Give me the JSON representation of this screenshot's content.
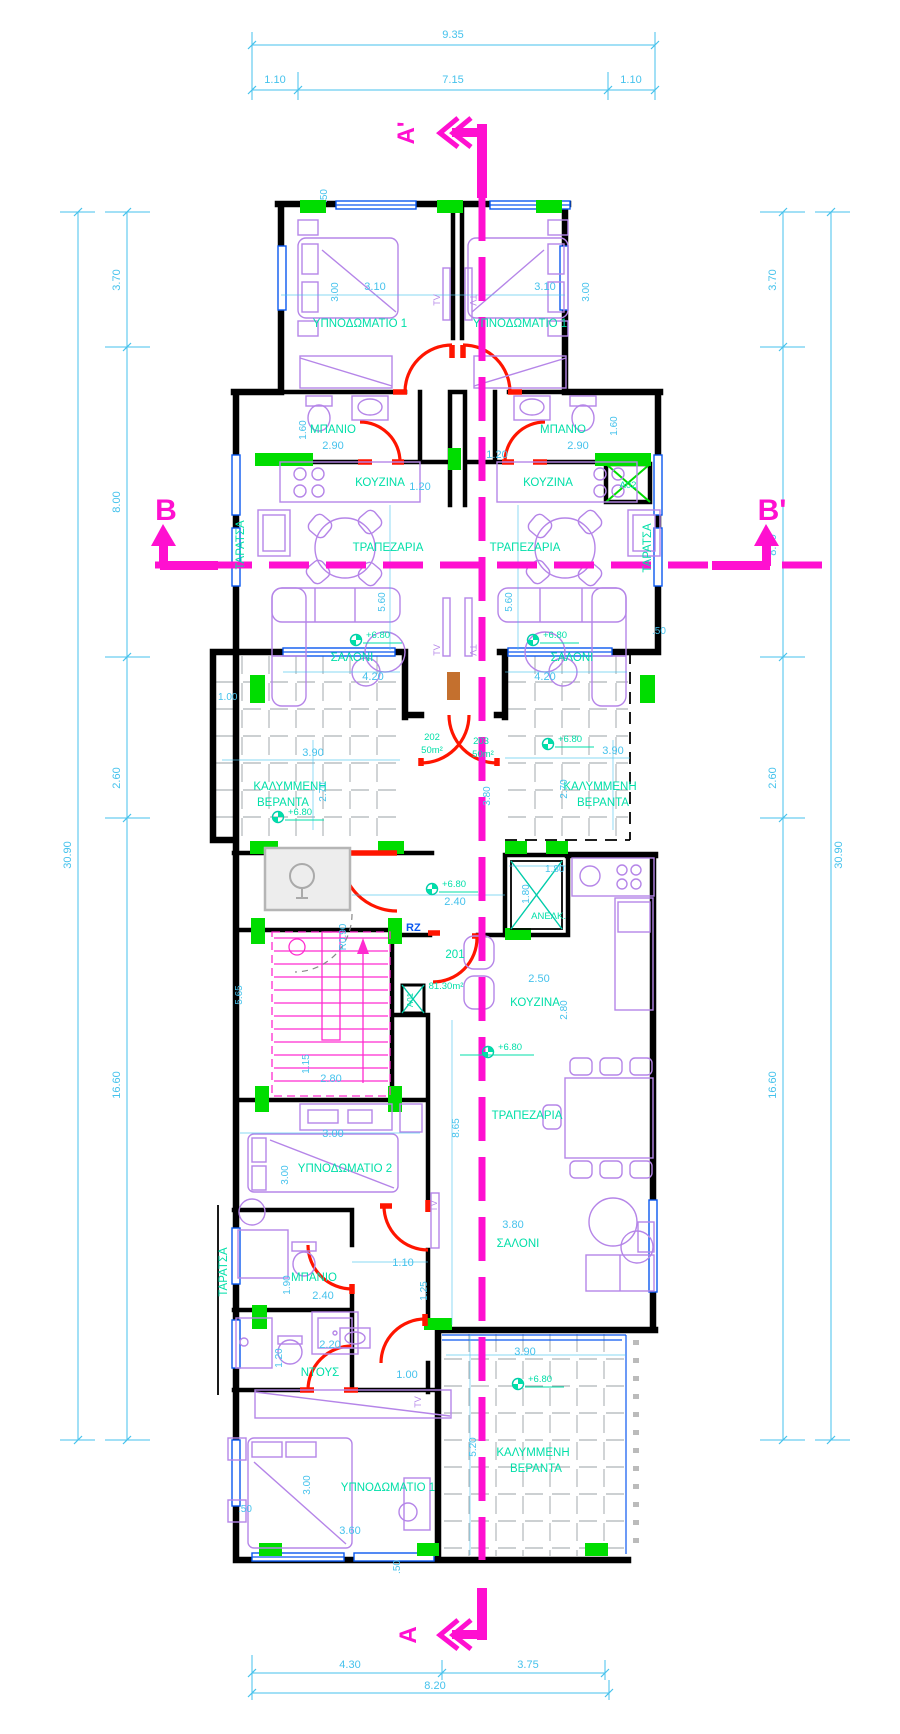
{
  "drawing": {
    "type": "architectural-floor-plan",
    "storey_level": "+6.80",
    "colors": {
      "walls": "#000000",
      "dimensions": "#45C2EC",
      "room_labels": "#00DFA8",
      "section_lines": "#FF10D0",
      "stairs": "#FF2BD0",
      "doors": "#FF1500",
      "columns": "#00DD00",
      "windows": "#0A58F0",
      "furniture": "#B585E8",
      "hatch": "#9AA0A6",
      "accent_panel": "#C4702E"
    },
    "t": {
      "bedroom1": "ΥΠΝΟΔΩΜΑΤΙΟ 1",
      "bedroom2": "ΥΠΝΟΔΩΜΑΤΙΟ 2",
      "bath": "ΜΠΑΝΙΟ",
      "kitchen": "ΚΟΥΖΙΝΑ",
      "dining": "ΤΡΑΠΕΖΑΡΙΑ",
      "salon": "ΣΑΛΟΝΙ",
      "covered": "ΚΑΛΥΜΜΕΝΗ",
      "veranda": "ΒΕΡΑΝΤΑ",
      "shower": "ΝΤΟΥΣ",
      "terrace": "ΤΑΡΑΤΣΑ",
      "elevator": "ΑΝΕΛΚ.",
      "tv": "TV",
      "level": "+6.80",
      "apt202": "202",
      "apt203": "203",
      "apt201": "201",
      "area50": "50m²",
      "area201": "81.30m²",
      "rz": "RZ",
      "shaftA02": "Α02",
      "shaftA01": "Α01",
      "secA": "A",
      "secAp": "A'",
      "secB": "B",
      "secBp": "B'"
    },
    "dim": {
      "d935": "9.35",
      "d110": "1.10",
      "d715": "7.15",
      "d430": "4.30",
      "d375": "3.75",
      "d820": "8.20",
      "d370": "3.70",
      "d800": "8.00",
      "d260": "2.60",
      "d1660": "16.60",
      "d3090": "30.90",
      "d310": "3.10",
      "d300": "3.00",
      "d050": ".50",
      "d160": "1.60",
      "d290": "2.90",
      "d120": "1.20",
      "d560": "5.60",
      "d420": "4.20",
      "d390": "3.90",
      "d270": "2.70",
      "d100": "1.00",
      "d240": "2.40",
      "d380": "3.80",
      "d180": "1.80",
      "dr090": "R0.90",
      "d565": "5.65",
      "d115": "1.15",
      "d280": "2.80",
      "d250": "2.50",
      "d865": "8.65",
      "d190": "1.90",
      "d125": "1.25",
      "d220": "2.20",
      "d360": "3.60",
      "d520": "5.20"
    }
  }
}
